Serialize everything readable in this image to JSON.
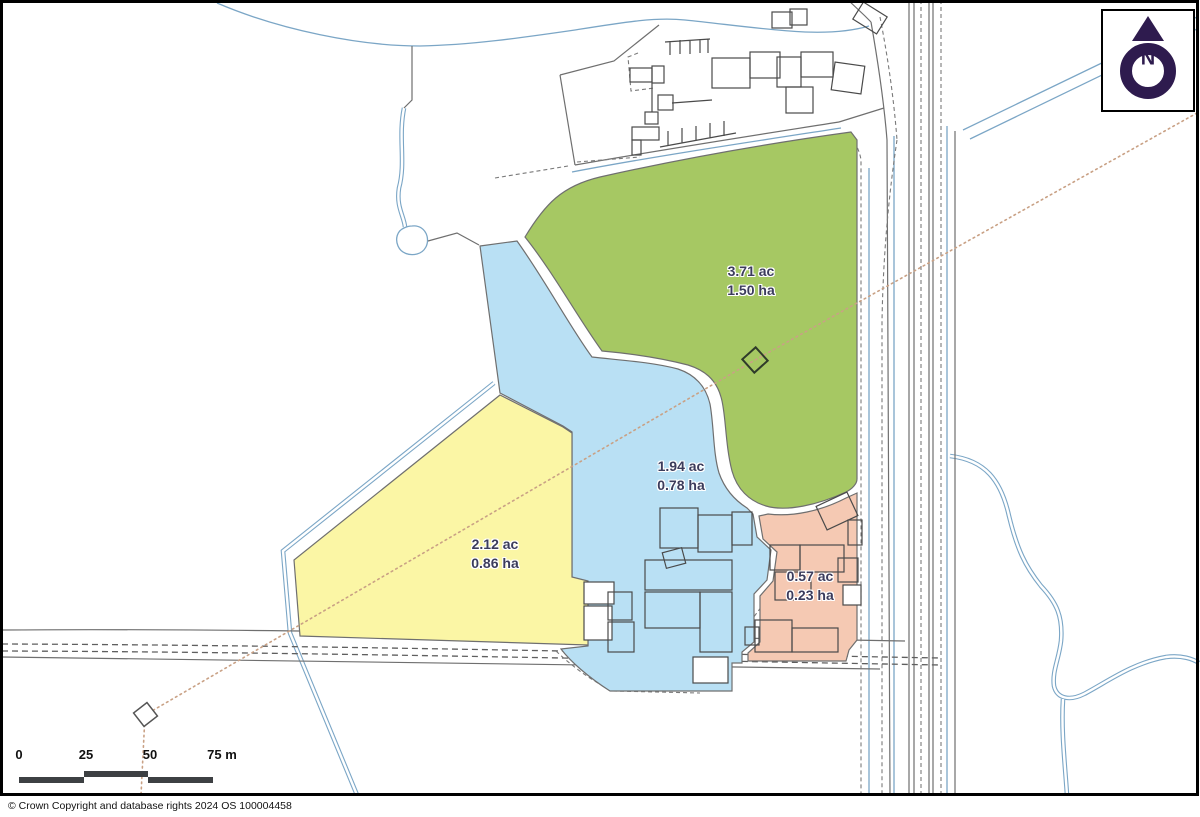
{
  "map": {
    "parcels": [
      {
        "name": "green",
        "acres": "3.71 ac",
        "hectares": "1.50 ha",
        "color": "#a6c863"
      },
      {
        "name": "blue",
        "acres": "1.94 ac",
        "hectares": "0.78 ha",
        "color": "#b9e0f4"
      },
      {
        "name": "yellow",
        "acres": "2.12 ac",
        "hectares": "0.86 ha",
        "color": "#fbf6a5"
      },
      {
        "name": "pink",
        "acres": "0.57 ac",
        "hectares": "0.23 ha",
        "color": "#f5c9b3"
      }
    ],
    "north_indicator": {
      "label": "N"
    },
    "scale_bar": {
      "ticks": [
        "0",
        "25",
        "50",
        "75 m"
      ]
    },
    "copyright": "© Crown Copyright and database rights 2024 OS 100004458"
  },
  "colors": {
    "water_line": "#7ba6c6",
    "boundary_line": "#6f6f6f",
    "building_line": "#4a4a4a",
    "sight_line": "#c9a185",
    "label_text": "#3c3c5c",
    "north_purple": "#2e1b4e",
    "scalebar_fill": "#3d4043",
    "frame": "#000000"
  }
}
